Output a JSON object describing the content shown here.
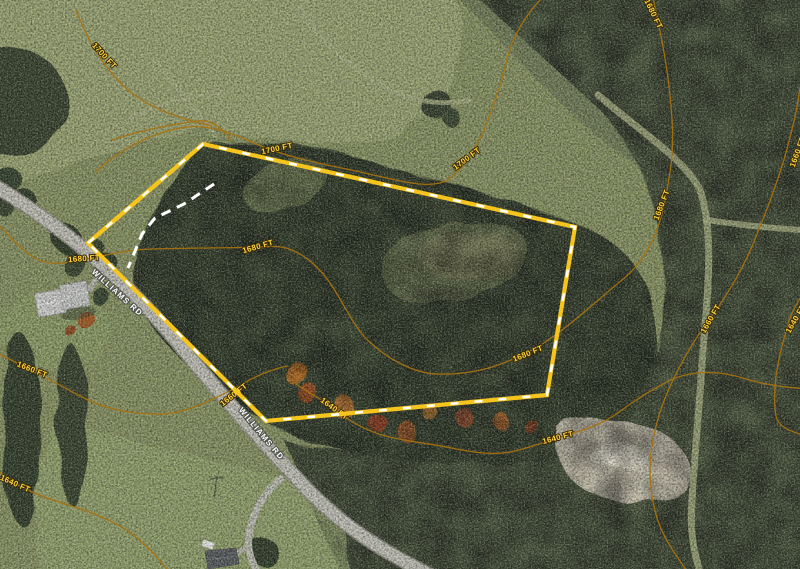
{
  "map": {
    "type": "aerial-parcel-map",
    "contour_labels": [
      {
        "text": "1700 FT",
        "x": 104,
        "y": 56,
        "angle": 47
      },
      {
        "text": "1700 FT",
        "x": 277,
        "y": 149,
        "angle": -12
      },
      {
        "text": "1700 FT",
        "x": 467,
        "y": 159,
        "angle": -37
      },
      {
        "text": "1680 FT",
        "x": 653,
        "y": 14,
        "angle": 64
      },
      {
        "text": "1680 FT",
        "x": 662,
        "y": 205,
        "angle": -69
      },
      {
        "text": "1660 FT",
        "x": 711,
        "y": 319,
        "angle": -60
      },
      {
        "text": "1640 FT",
        "x": 796,
        "y": 319,
        "angle": -60
      },
      {
        "text": "1660 FT",
        "x": 798,
        "y": 152,
        "angle": -70
      },
      {
        "text": "1680 FT",
        "x": 84,
        "y": 259,
        "angle": -4
      },
      {
        "text": "1680 FT",
        "x": 258,
        "y": 247,
        "angle": -16
      },
      {
        "text": "1680 FT",
        "x": 528,
        "y": 354,
        "angle": -22
      },
      {
        "text": "1660 FT",
        "x": 234,
        "y": 395,
        "angle": -38
      },
      {
        "text": "1640 FT",
        "x": 334,
        "y": 409,
        "angle": 36
      },
      {
        "text": "1640 FT",
        "x": 558,
        "y": 438,
        "angle": -15
      },
      {
        "text": "1660 FT",
        "x": 32,
        "y": 370,
        "angle": 22
      },
      {
        "text": "1640 FT",
        "x": 15,
        "y": 484,
        "angle": 24
      }
    ],
    "road_labels": [
      {
        "text": "WILLIAMS RD",
        "x": 117,
        "y": 293,
        "angle": 42
      },
      {
        "text": "WILLIAMS RD",
        "x": 261,
        "y": 434,
        "angle": 50
      }
    ],
    "roads": {
      "name": "WILLIAMS RD",
      "label_color": "#FFFFFF",
      "label_halo": "#4E524A"
    },
    "contours": {
      "line_color": "#A8720F",
      "label_color": "#FFD43D",
      "label_halo": "#392A08",
      "paths": [
        "M 76,10 C 88,40 102,66 126,88 C 148,108 178,118 212,126",
        "M 96,172 C 120,148 158,130 188,127 C 218,124 245,140 266,148 C 300,161 340,167 378,176 C 408,183 430,188 446,181 C 460,172 474,152 484,130 C 493,108 500,88 506,64 C 511,38 526,14 544,-4",
        "M 112,140 C 142,130 172,124 200,121 C 214,120 224,130 232,141",
        "M -6,222 C 8,232 18,248 32,256 C 50,268 70,262 86,259 C 104,256 122,250 152,249 C 184,248 226,248 258,247 C 274,246 284,246 294,251 C 312,259 326,276 334,289 C 346,308 356,331 372,344 C 392,362 416,373 436,374 C 462,375 487,370 506,362 C 522,356 541,346 558,333 C 580,317 602,296 621,281 C 637,268 649,252 657,230 C 663,212 666,198 669,178 C 674,154 673,128 671,106 C 668,70 661,32 652,-6",
        "M -6,352 C 10,358 20,366 34,372 C 52,380 66,389 84,398 C 106,409 126,413 152,414 C 172,415 188,410 202,404 C 218,397 232,390 244,383 C 258,375 272,369 288,366",
        "M 296,384 C 314,396 326,402 336,410 C 348,420 362,429 382,435 C 406,442 430,443 456,449 C 478,453 494,455 510,452 C 530,448 544,442 560,437 C 582,431 602,425 622,410 C 642,395 656,388 669,381 C 692,369 722,371 746,379 C 766,385 784,387 806,389",
        "M 803,294 C 796,304 792,312 789,321 C 783,341 779,356 776,376 C 774,392 774,404 776,416 C 778,425 786,430 800,434",
        "M 688,573 C 677,556 665,541 658,521 C 650,496 648,471 652,446 C 655,426 661,405 673,380 C 685,355 700,331 715,312 C 729,292 743,268 753,244 C 763,220 773,194 781,169 C 787,151 791,134 795,117 C 798,104 799,90 802,78",
        "M -6,469 C 5,475 10,480 18,485 C 32,493 46,498 62,503 C 82,509 102,516 120,526 C 137,536 150,549 160,561 C 164,566 168,570 172,574"
      ]
    },
    "parcel": {
      "line_color": "#F6C51D",
      "dash_color": "#FFFFFF",
      "vertices": [
        [
          88,
          243
        ],
        [
          203,
          144
        ],
        [
          575,
          227
        ],
        [
          547,
          395
        ],
        [
          266,
          421
        ]
      ]
    },
    "driveway_dashed": {
      "color": "#FFFFFF",
      "points": [
        [
          214,
          184
        ],
        [
          184,
          204
        ],
        [
          155,
          218
        ],
        [
          142,
          234
        ],
        [
          133,
          256
        ],
        [
          128,
          268
        ]
      ]
    }
  }
}
